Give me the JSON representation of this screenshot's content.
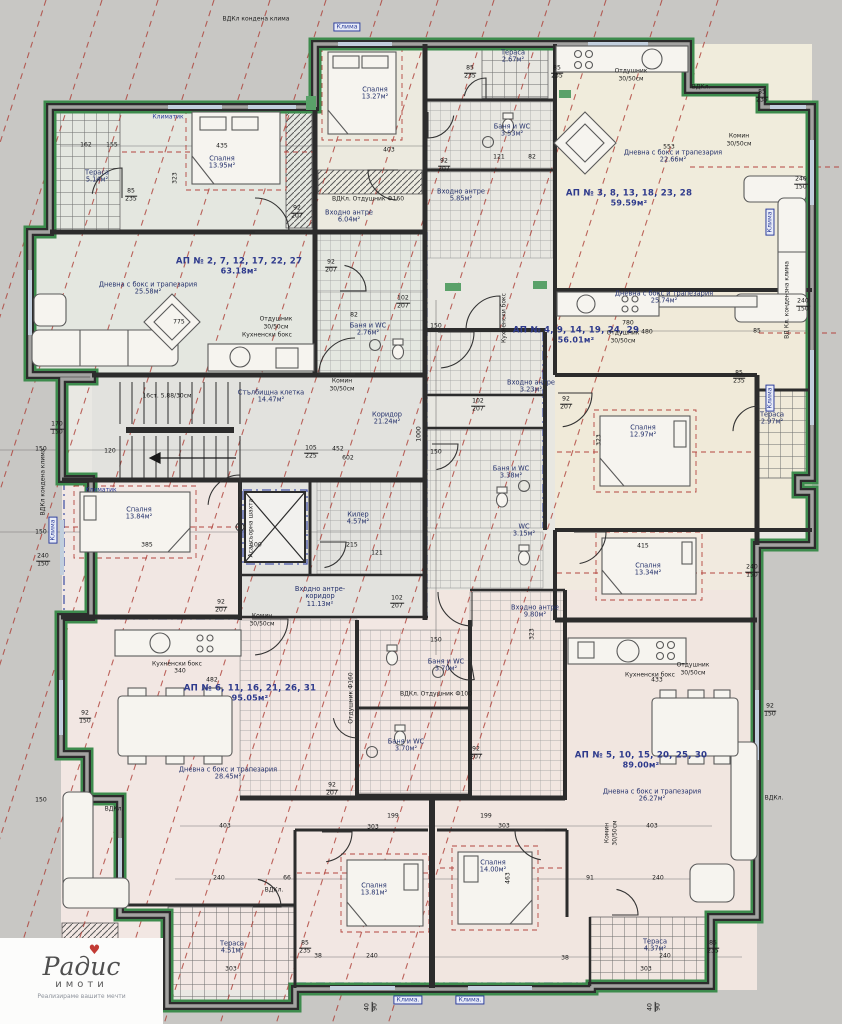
{
  "logo": {
    "brand": "Радис",
    "sub": "имоти",
    "tagline": "Реализираме вашите мечти"
  },
  "colors": {
    "wall": "#2c2c2c",
    "outline_green": "#3d8b4d",
    "guide_red": "#ad3d35",
    "accent_blue": "#2c3e9e",
    "label_blue": "#2e3a8c"
  },
  "apartments": [
    {
      "label": "АП № 2, 7, 12, 17, 22, 27",
      "area": "63.18м²"
    },
    {
      "label": "АП № 3, 8, 13, 18, 23, 28",
      "area": "59.59м²"
    },
    {
      "label": "АП № 4, 9, 14, 19, 24, 29",
      "area": "56.01м²"
    },
    {
      "label": "АП № 5, 10, 15, 20, 25, 30",
      "area": "89.00м²"
    },
    {
      "label": "АП № 6, 11, 16, 21, 26, 31",
      "area": "95.05м²"
    }
  ],
  "rooms": [
    {
      "name": "Тераса",
      "area": "5.14м²"
    },
    {
      "name": "Спалня",
      "area": "13.95м²"
    },
    {
      "name": "Спалня",
      "area": "13.27м²"
    },
    {
      "name": "Тераса",
      "area": "2.67м²"
    },
    {
      "name": "Баня и WC",
      "area": "3.53м²"
    },
    {
      "name": "Входно антре",
      "area": "5.85м²"
    },
    {
      "name": "Дневна с бокс и трапезария",
      "area": "22.66м²"
    },
    {
      "name": "Входно антре",
      "area": "6.04м²"
    },
    {
      "name": "Дневна с бокс и трапезария",
      "area": "25.58м²"
    },
    {
      "name": "Баня и WC",
      "area": "2.76м²"
    },
    {
      "name": "Стълбищна клетка",
      "area": "14.47м²"
    },
    {
      "name": "Коридор",
      "area": "21.24м²"
    },
    {
      "name": "Дневна с бокс и трапезария",
      "area": "25.74м²"
    },
    {
      "name": "Входно антре",
      "area": "3.23м²"
    },
    {
      "name": "Спалня",
      "area": "12.97м²"
    },
    {
      "name": "Тераса",
      "area": "2.97м²"
    },
    {
      "name": "Баня и WC",
      "area": "3.38м²"
    },
    {
      "name": "Спалня",
      "area": "13.84м²"
    },
    {
      "name": "Килер",
      "area": "4.57м²"
    },
    {
      "name": "Спалня",
      "area": "13.34м²"
    },
    {
      "name": "WC",
      "area": "3.15м²"
    },
    {
      "name": "Входно антре-коридор",
      "area": "11.13м²"
    },
    {
      "name": "Входно антре",
      "area": "9.80м²"
    },
    {
      "name": "Баня и WC",
      "area": "3.70м²"
    },
    {
      "name": "Баня и WC",
      "area": "3.70м²"
    },
    {
      "name": "Дневна с бокс и трапезария",
      "area": "28.45м²"
    },
    {
      "name": "Дневна с бокс и трапезария",
      "area": "26.27м²"
    },
    {
      "name": "Спалня",
      "area": "13.81м²"
    },
    {
      "name": "Спалня",
      "area": "14.00м²"
    },
    {
      "name": "Тераса",
      "area": "4.51м²"
    },
    {
      "name": "Тераса",
      "area": "4.37м²"
    }
  ],
  "stair_note": "16ст. 5.88/30см",
  "annotations": [
    "Кухненски бокс",
    "Отдушник",
    "30/50см",
    "Комин",
    "Клима",
    "Клима.",
    "ВДКл.",
    "ВДКл кондена клима",
    "ВД Кл. кондензна клима",
    "ВДКл. Отдушник Ф160",
    "ВДКл. Отдушник Ф100",
    "Отдушник Ф160",
    "Климатик",
    "Асансьорна шахта"
  ],
  "dimensions": [
    "162",
    "155",
    "435",
    "403",
    "323",
    "85/235",
    "240/150",
    "170/150",
    "92/150",
    "553",
    "780",
    "480",
    "85",
    "120",
    "105/225",
    "452",
    "602",
    "385",
    "215",
    "121",
    "150",
    "482",
    "340",
    "433",
    "303",
    "199",
    "240",
    "38",
    "66",
    "91",
    "463",
    "415",
    "92/207",
    "102/207",
    "82",
    "100",
    "1000",
    "40/90",
    "775"
  ]
}
